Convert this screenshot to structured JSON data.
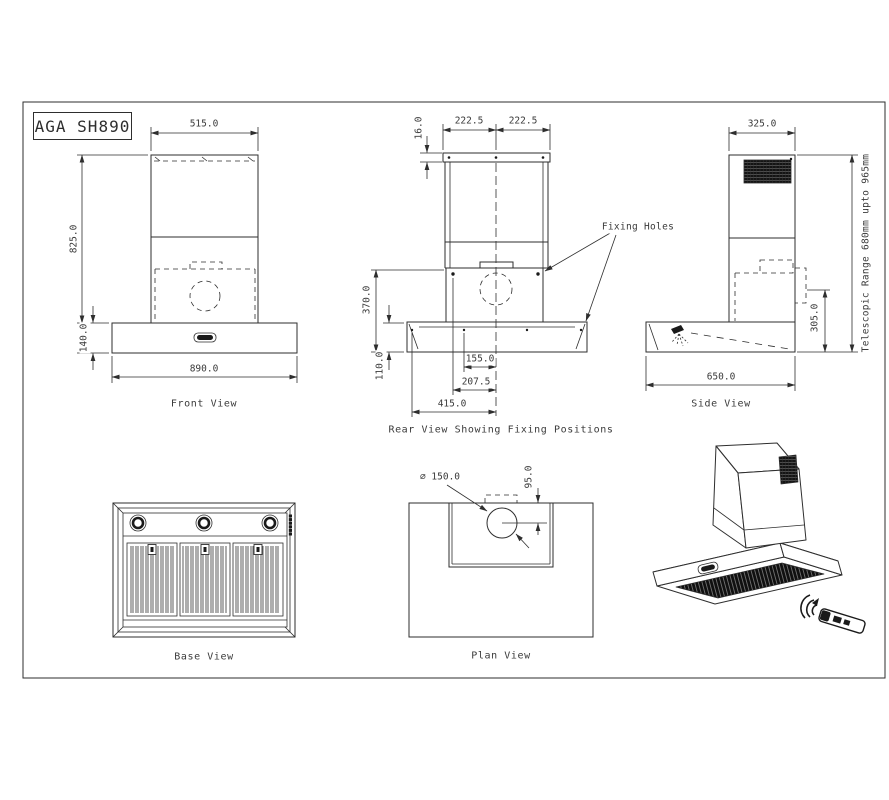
{
  "title_block": {
    "model": "AGA SH890"
  },
  "annotations": {
    "fixing_holes": "Fixing Holes"
  },
  "front_view": {
    "caption": "Front View",
    "dims": {
      "top_width": "515.0",
      "total_height": "825.0",
      "canopy_height": "140.0",
      "overall_width": "890.0"
    }
  },
  "rear_view": {
    "caption": "Rear View Showing Fixing Positions",
    "dims": {
      "bracket_offset": "16.0",
      "hole_spacing_left": "222.5",
      "hole_spacing_right": "222.5",
      "panel_height": "370.0",
      "canopy_height": "110.0",
      "hole_155": "155.0",
      "hole_207": "207.5",
      "hole_415": "415.0"
    }
  },
  "side_view": {
    "caption": "Side View",
    "dims": {
      "top_depth": "325.0",
      "rear_height": "305.0",
      "overall_depth": "650.0"
    },
    "note_telescopic": "Telescopic Range 680mm upto 965mm"
  },
  "base_view": {
    "caption": "Base View"
  },
  "plan_view": {
    "caption": "Plan View",
    "dims": {
      "duct_diameter": "∅ 150.0",
      "duct_offset": "95.0"
    }
  }
}
